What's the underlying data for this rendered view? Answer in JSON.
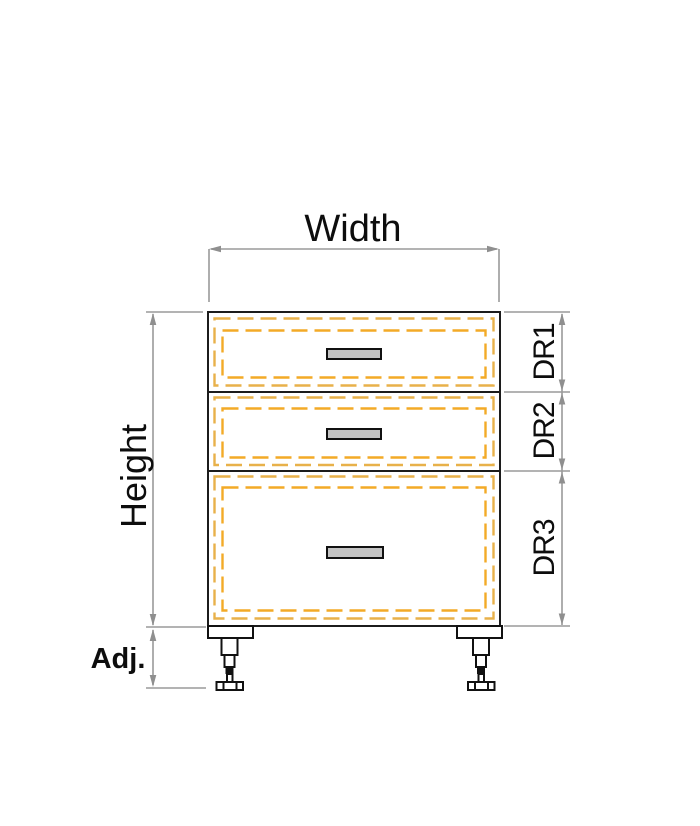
{
  "figure": {
    "type": "cabinet-elevation-drawing",
    "description": "Base cabinet with three drawers, dimension annotations and adjustable feet",
    "dimension_labels": {
      "width": "Width",
      "height": "Height",
      "adjustable_feet": "Adj."
    },
    "drawer_dimension_labels": [
      {
        "id": "drawer-1",
        "label": "DR1"
      },
      {
        "id": "drawer-2",
        "label": "DR2"
      },
      {
        "id": "drawer-3",
        "label": "DR3"
      }
    ],
    "colors": {
      "dimension_line": "#9a9a9a",
      "arrowhead": "#8f8f8f",
      "outline": "#1c1c1c",
      "drawer_dash_outer": "#e8b14a",
      "drawer_dash_inner": "#f3aa27",
      "handle_fill": "#c3c3c3",
      "handle_border": "#111111",
      "label_text": "#0d0d0d"
    }
  }
}
